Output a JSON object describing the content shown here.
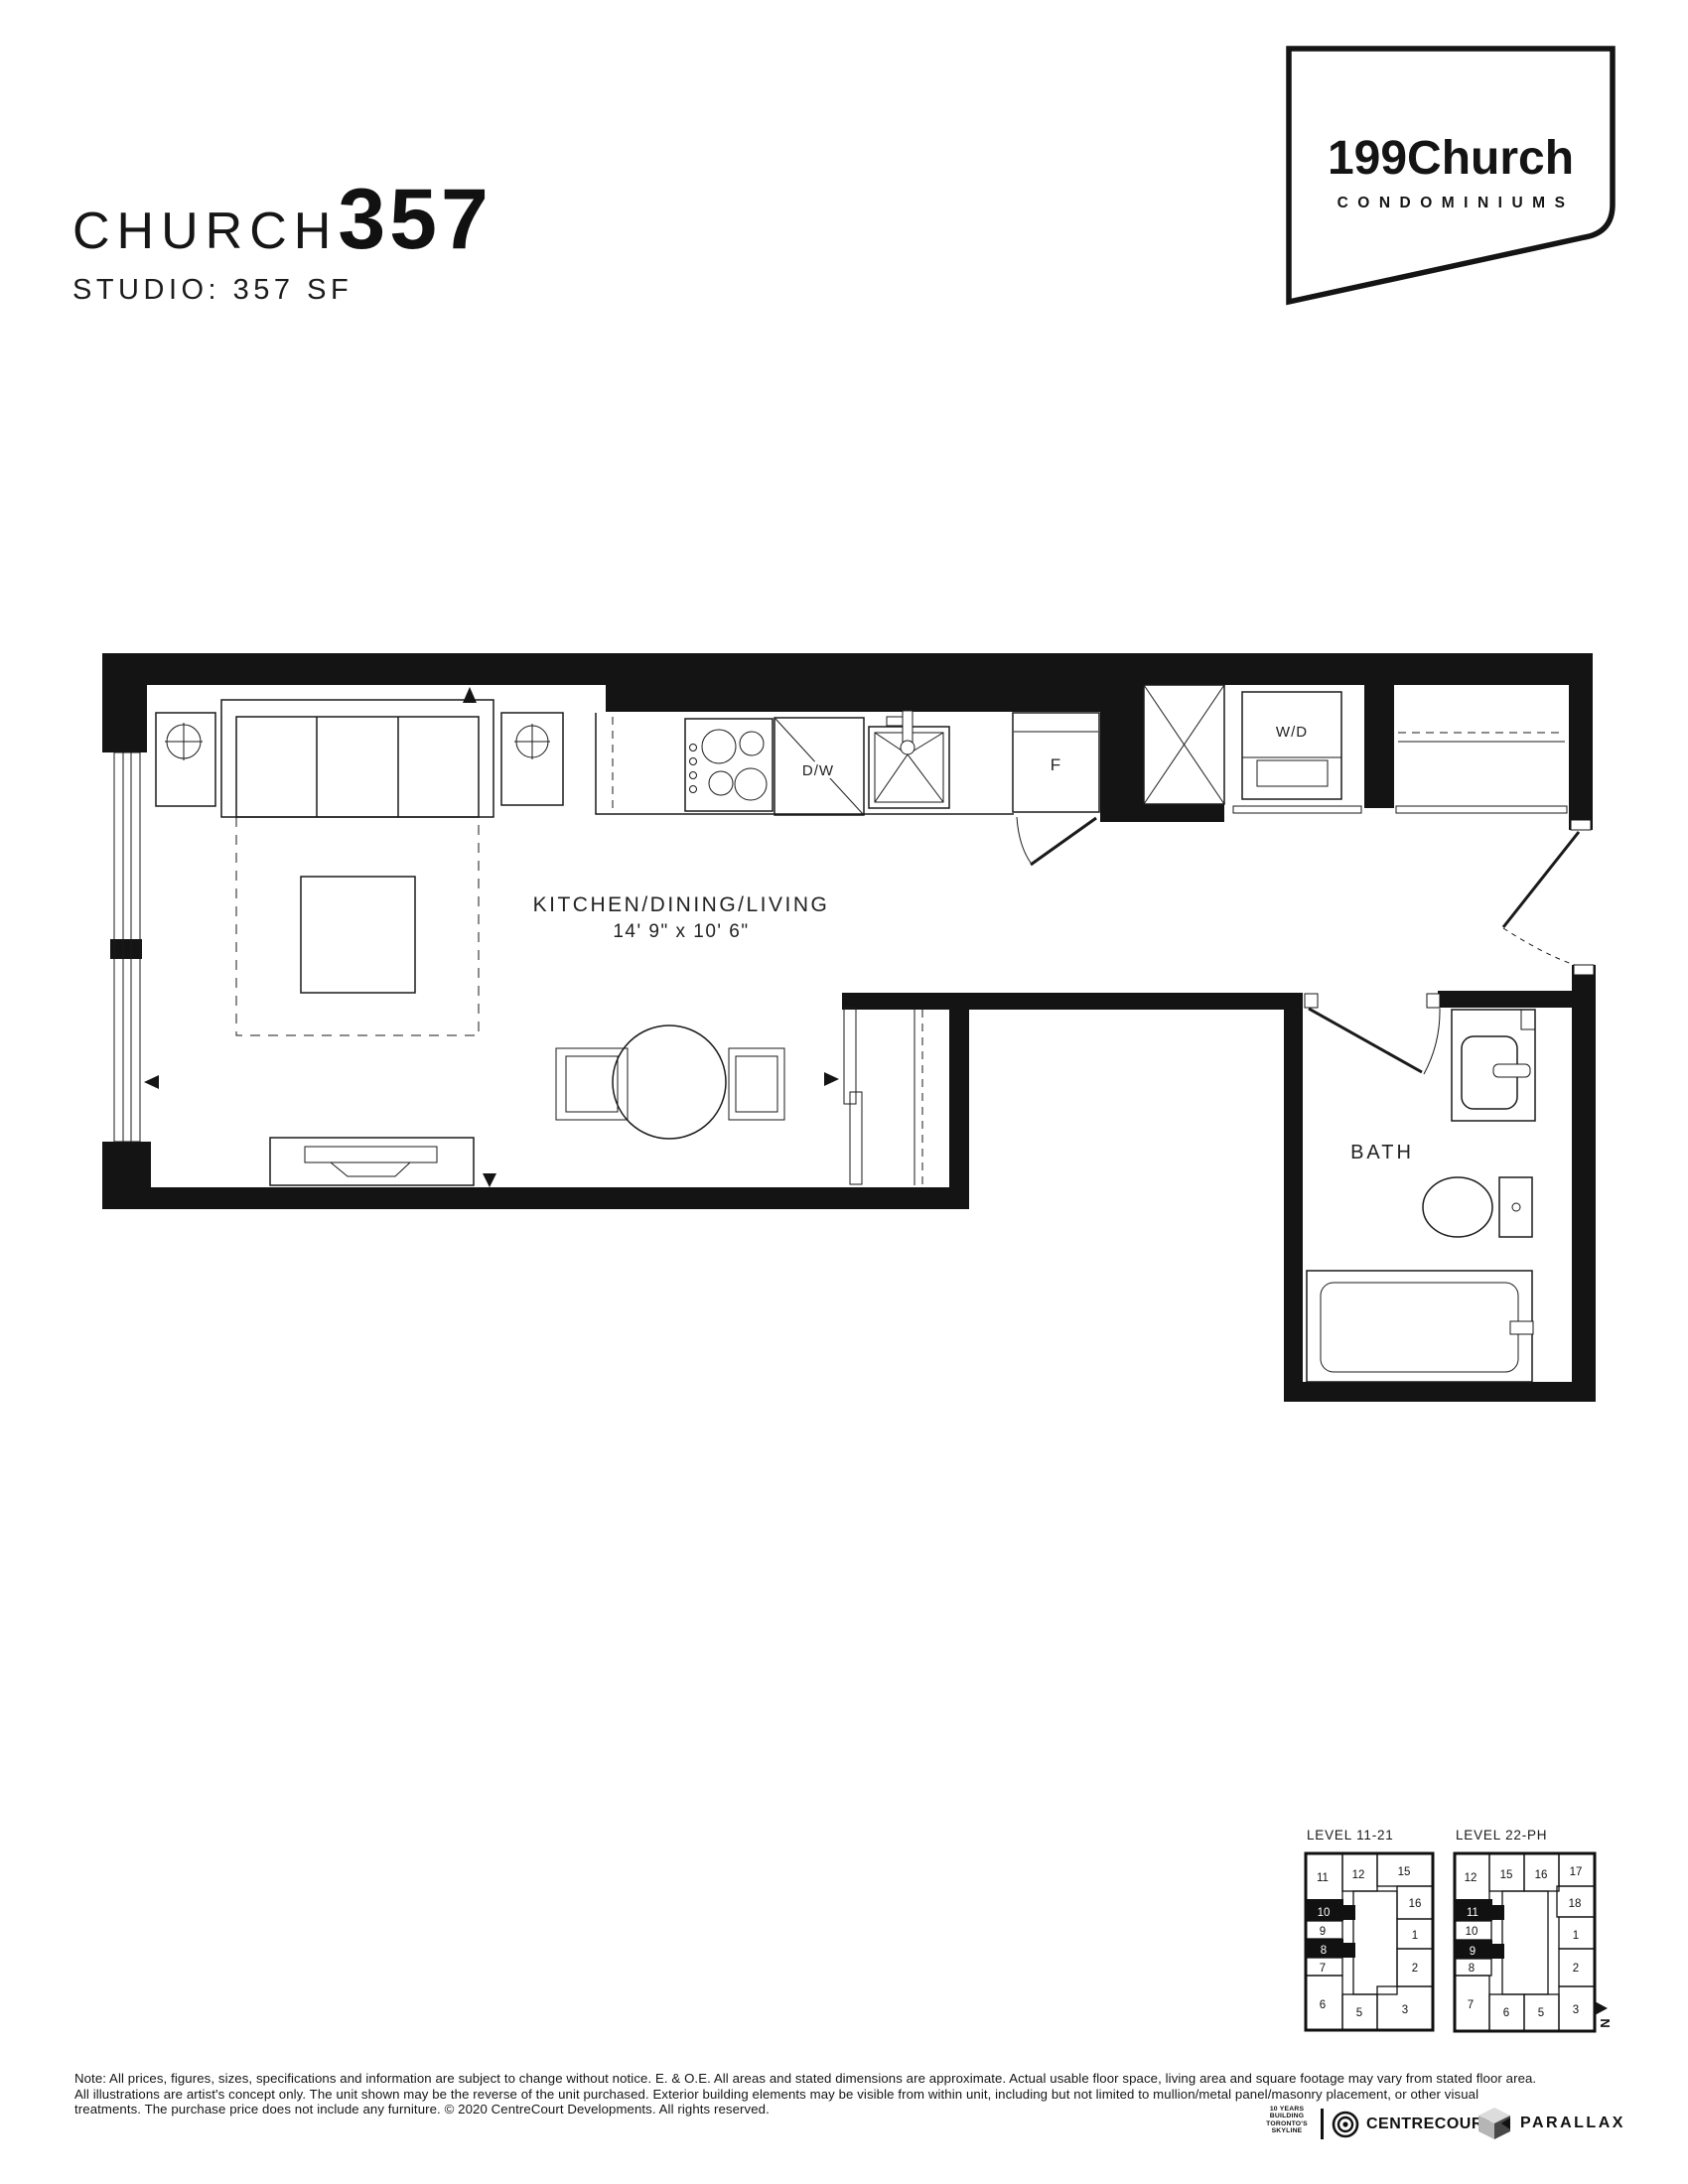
{
  "header": {
    "title_light": "CHURCH",
    "title_bold": "357",
    "subtitle": "STUDIO: 357 SF"
  },
  "logo": {
    "brand": "199Church",
    "tagline": "CONDOMINIUMS"
  },
  "floorplan": {
    "room_label": "KITCHEN/DINING/LIVING",
    "room_dims": "14' 9\" x 10' 6\"",
    "bath_label": "BATH",
    "washer_dryer_label": "W/D",
    "dishwasher_label": "D/W",
    "fridge_label": "F"
  },
  "keyplans": [
    {
      "title": "LEVEL 11-21",
      "units": [
        {
          "label": "11",
          "highlight": false
        },
        {
          "label": "12",
          "highlight": false
        },
        {
          "label": "15",
          "highlight": false
        },
        {
          "label": "16",
          "highlight": false
        },
        {
          "label": "1",
          "highlight": false
        },
        {
          "label": "2",
          "highlight": false
        },
        {
          "label": "3",
          "highlight": false
        },
        {
          "label": "5",
          "highlight": false
        },
        {
          "label": "6",
          "highlight": false
        },
        {
          "label": "7",
          "highlight": false
        },
        {
          "label": "8",
          "highlight": true
        },
        {
          "label": "9",
          "highlight": false
        },
        {
          "label": "10",
          "highlight": true
        }
      ]
    },
    {
      "title": "LEVEL 22-PH",
      "units": [
        {
          "label": "12",
          "highlight": false
        },
        {
          "label": "15",
          "highlight": false
        },
        {
          "label": "16",
          "highlight": false
        },
        {
          "label": "17",
          "highlight": false
        },
        {
          "label": "18",
          "highlight": false
        },
        {
          "label": "1",
          "highlight": false
        },
        {
          "label": "2",
          "highlight": false
        },
        {
          "label": "3",
          "highlight": false
        },
        {
          "label": "5",
          "highlight": false
        },
        {
          "label": "6",
          "highlight": false
        },
        {
          "label": "7",
          "highlight": false
        },
        {
          "label": "8",
          "highlight": false
        },
        {
          "label": "9",
          "highlight": true
        },
        {
          "label": "10",
          "highlight": false
        },
        {
          "label": "11",
          "highlight": true
        }
      ]
    }
  ],
  "north_arrow": {
    "label": "N"
  },
  "disclaimer": {
    "lines": [
      "Note: All prices, figures, sizes, specifications and information are subject to change without notice. E. & O.E. All areas and stated dimensions are approximate. Actual usable floor space, living area and square footage may vary from stated floor area.",
      "All illustrations are artist's concept only. The unit shown may be the reverse of the unit purchased. Exterior building elements may be visible from within unit, including but not limited to mullion/metal panel/masonry placement, or other visual",
      "treatments. The purchase price does not include any furniture. © 2020 CentreCourt Developments. All rights reserved."
    ]
  },
  "footer": {
    "years_badge_lines": [
      "10 YEARS",
      "BUILDING",
      "TORONTO'S",
      "SKYLINE"
    ],
    "centrecourt_label": "CENTRECOURT",
    "parallax_label": "PARALLAX"
  }
}
